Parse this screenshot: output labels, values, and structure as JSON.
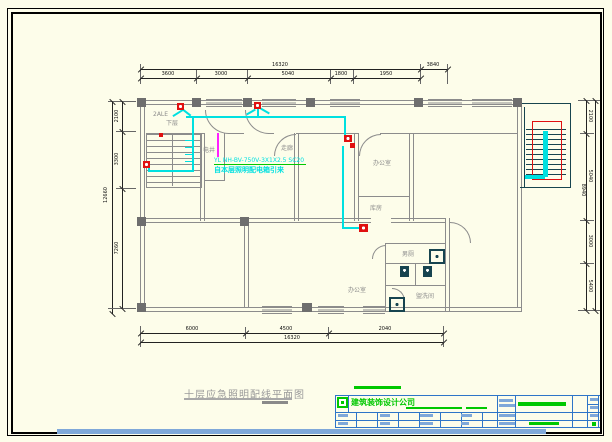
{
  "colors": {
    "paper": "#FDFDEA",
    "wall": "#8C8C8C",
    "cyan": "#00E0E0",
    "red": "#E01010",
    "magenta": "#FF20FF",
    "teal": "#17444F",
    "green": "#00C800",
    "blue-line": "#2E75C8",
    "blue-bar": "#7FA8D9",
    "label-gray": "#8C8C8C"
  },
  "drawing": {
    "title": "十层应急照明配线平面图"
  },
  "wire_note": {
    "line1": "YL NH-BV-750V-3X1X2.5 SC20",
    "line2": "自本层照明配电箱引来"
  },
  "plan_labels": {
    "panel": "2ALE",
    "lower_floor": "下层",
    "shaft": "电井",
    "corridor": "走廊",
    "office_right": "办公室",
    "storage": "库房",
    "office_bottom": "办公室",
    "toilet_male": "男厕",
    "washroom": "盥洗间"
  },
  "dims": {
    "top": {
      "overall": "16320",
      "right_seg": "3840",
      "segments": [
        "3600",
        "3000",
        "5040",
        "1800",
        "1950"
      ]
    },
    "bottom": {
      "overall": "16320",
      "segments": [
        "6000",
        "4500",
        "2040"
      ]
    },
    "left": {
      "overall": "12660",
      "segments": [
        "2100",
        "3300",
        "7260"
      ]
    },
    "right": {
      "overall": "8940",
      "segments": [
        "2100",
        "5040",
        "3000",
        "5400"
      ]
    }
  },
  "title_block": {
    "company": "建筑装饰设计公司"
  }
}
